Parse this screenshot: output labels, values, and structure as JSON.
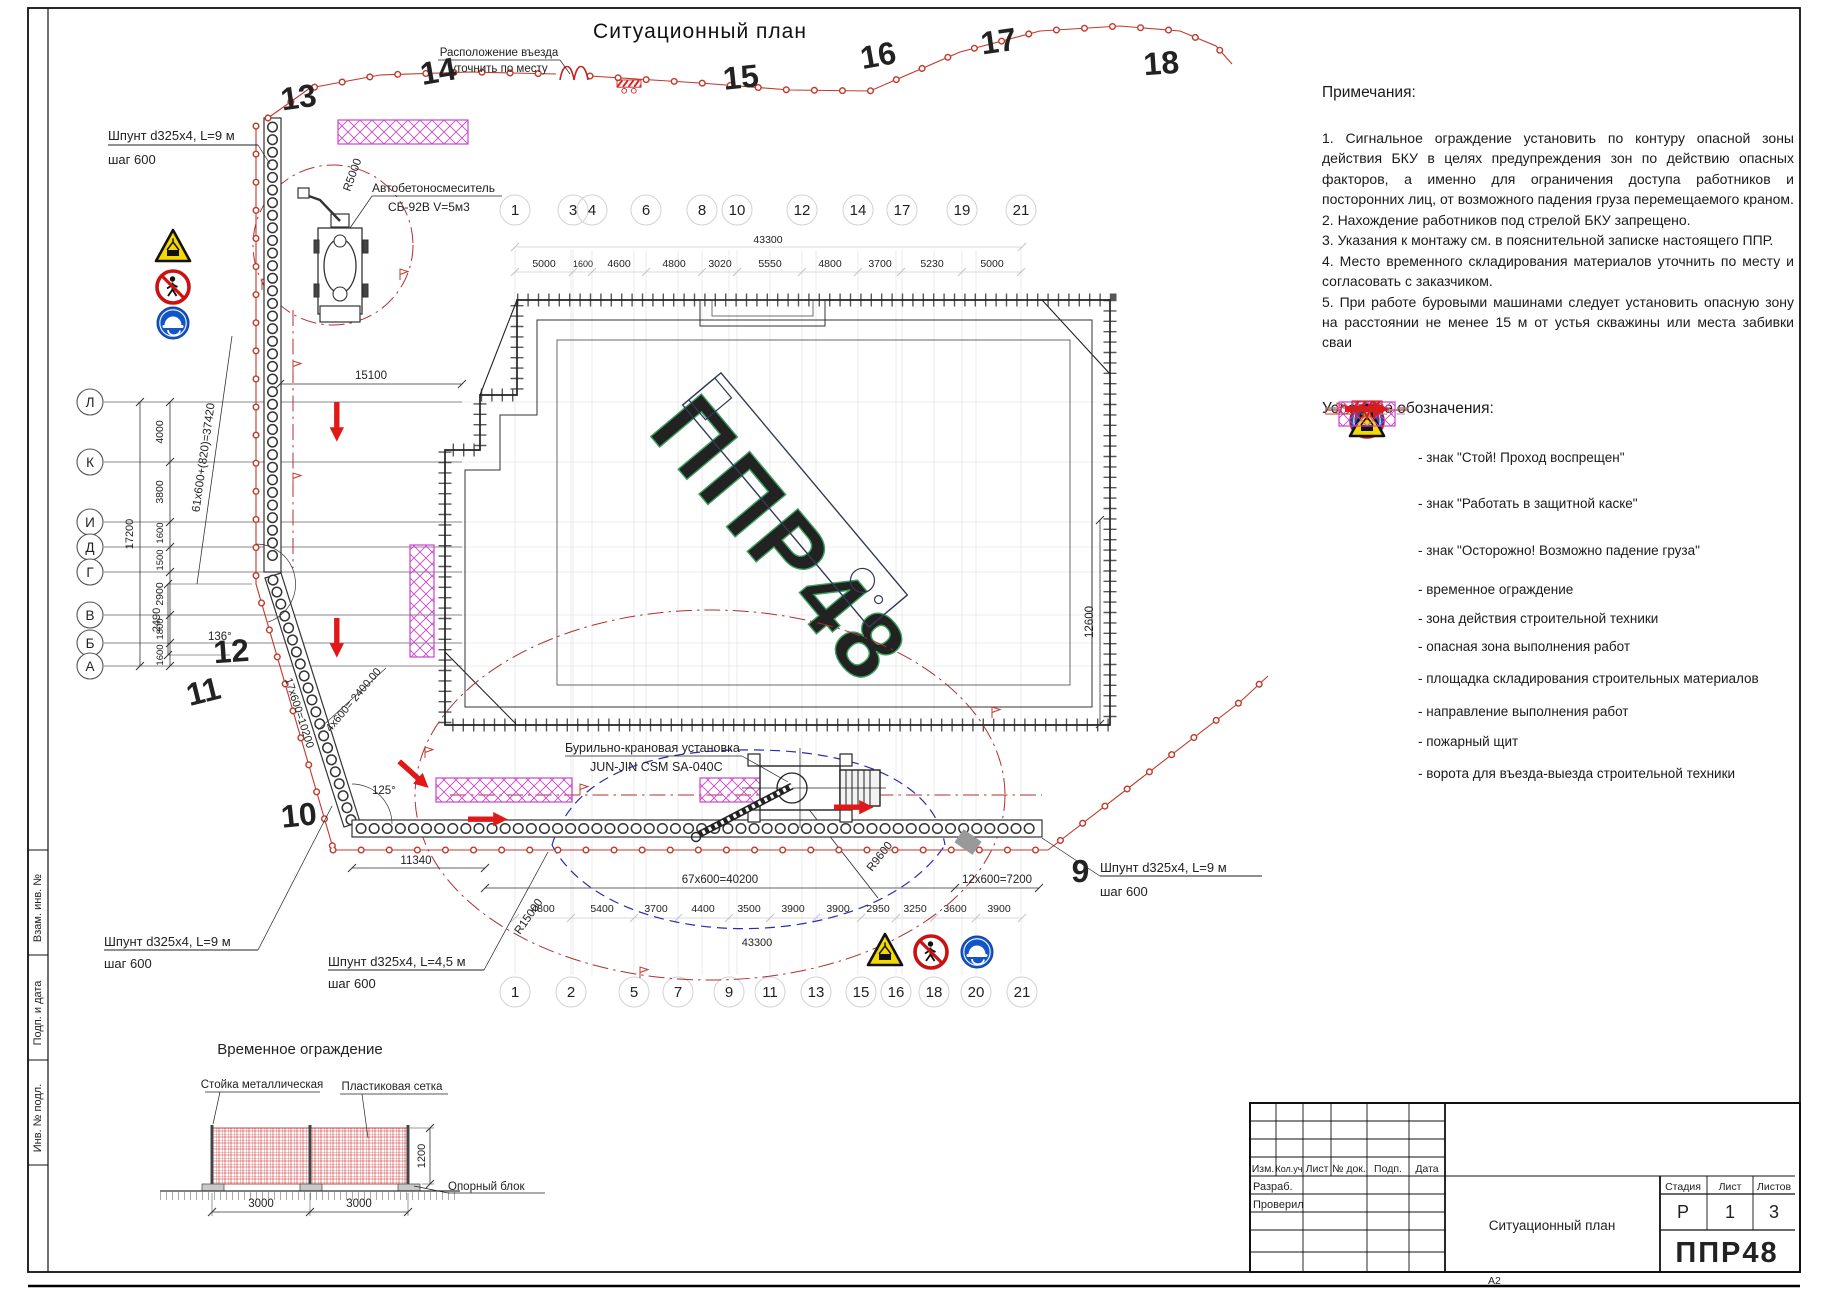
{
  "sheet": {
    "title": "Ситуационный план",
    "format": "А2",
    "frame_labels": [
      "Взам. инв. №",
      "Подп. и дата",
      "Инв. № подл."
    ]
  },
  "notes": {
    "heading": "Примечания:",
    "items": [
      "1. Сигнальное ограждение установить по контуру опасной зоны действия БКУ в целях предупреждения зон по действию опасных факторов, а именно для ограничения доступа работников и посторонних лиц, от возможного падения груза перемещаемого краном.",
      "2. Нахождение работников под стрелой БКУ запрещено.",
      "3. Указания к монтажу см. в пояснительной записке настоящего ППР.",
      "4. Место временного складирования материалов уточнить по месту и согласовать с заказчиком.",
      "5. При работе буровыми машинами следует установить опасную зону на расстоянии не менее 15 м от устья скважины или места забивки сваи"
    ]
  },
  "legend": {
    "heading": "Условные обозначения:",
    "items": [
      {
        "icon": "no-pedestrian-sign",
        "label": "- знак \"Стой! Проход воспрещен\""
      },
      {
        "icon": "hard-hat-sign",
        "label": "- знак \"Работать в защитной каске\""
      },
      {
        "icon": "falling-load-sign",
        "label": "- знак \"Осторожно! Возможно падение груза\""
      },
      {
        "icon": "temporary-fence-line",
        "label": "- временное ограждение"
      },
      {
        "icon": "machinery-zone-dash",
        "label": "- зона действия строительной техники"
      },
      {
        "icon": "danger-zone-line",
        "label": "- опасная зона выполнения работ"
      },
      {
        "icon": "storage-area-hatch",
        "label": "- площадка складирования строительных материалов"
      },
      {
        "icon": "work-direction-arrow",
        "label": "- направление выполнения работ"
      },
      {
        "icon": "fire-shield",
        "label": "- пожарный щит"
      },
      {
        "icon": "gate-symbol",
        "label": "- ворота для въезда-выезда строительной техники"
      }
    ]
  },
  "plan": {
    "entrance_note_1": "Расположение въезда",
    "entrance_note_2": "уточнить по месту",
    "truck_label_1": "Автобетоносмеситель",
    "truck_label_2": "СБ-92В V=5м3",
    "crane_label_1": "Бурильно-крановая установка",
    "crane_label_2": "JUN-JIN CSM SA-040C",
    "pile_left_1": "Шпунт d325x4, L=9 м",
    "pile_left_2": "шаг 600",
    "pile_bl_1": "Шпунт d325x4, L=9 м",
    "pile_bl_2": "шаг 600",
    "pile_bc_1": "Шпунт d325x4, L=4,5 м",
    "pile_bc_2": "шаг 600",
    "pile_r_1": "Шпунт d325x4, L=9 м",
    "pile_r_2": "шаг 600",
    "r_truck": "R5000",
    "r_crane": "R9600",
    "r_danger": "R15000",
    "angle_top": "136°",
    "angle_bottom": "125°",
    "fence_numbers": [
      "9",
      "10",
      "11",
      "12",
      "13",
      "14",
      "15",
      "16",
      "17",
      "18"
    ]
  },
  "grid": {
    "top_axes": [
      "1",
      "3",
      "4",
      "6",
      "8",
      "10",
      "12",
      "14",
      "17",
      "19",
      "21"
    ],
    "top_dims": [
      "5000",
      "1600",
      "4600",
      "4800",
      "3020",
      "5550",
      "4800",
      "3700",
      "5230",
      "5000"
    ],
    "top_total": "43300",
    "bottom_axes": [
      "1",
      "2",
      "5",
      "7",
      "9",
      "11",
      "13",
      "15",
      "16",
      "18",
      "20",
      "21"
    ],
    "bottom_dims": [
      "4800",
      "5400",
      "3700",
      "4400",
      "3500",
      "3900",
      "3900",
      "2950",
      "3250",
      "3600",
      "3900"
    ],
    "bottom_total": "43300",
    "left_axes": [
      "Л",
      "К",
      "И",
      "Д",
      "Г",
      "В",
      "Б",
      "А"
    ],
    "left_dims": [
      "4000",
      "3800",
      "1600",
      "1500",
      "2900",
      "1800",
      "1600"
    ],
    "left_total": "17200",
    "left_run": "61x600+(820)=37420",
    "dim_15100": "15100",
    "dim_11340": "11340",
    "dim_2490": "2490",
    "dim_12600": "12600",
    "run_bottom": "67x600=40200",
    "run_right": "12x600=7200",
    "run_diag_short": "4x600= 2400.00",
    "run_diag_long": "17x600=10200"
  },
  "detail": {
    "title": "Временное ограждение",
    "post_label": "Стойка металлическая",
    "mesh_label": "Пластиковая сетка",
    "block_label": "Опорный блок",
    "width_1": "3000",
    "width_2": "3000",
    "height": "1200"
  },
  "title_block": {
    "header_cols": [
      "Изм.",
      "Кол.уч",
      "Лист",
      "№ док.",
      "Подп.",
      "Дата"
    ],
    "row_labels": [
      "Разраб.",
      "Проверил"
    ],
    "stage_label": "Стадия",
    "sheet_label": "Лист",
    "sheets_label": "Листов",
    "stage": "Р",
    "sheet": "1",
    "sheets": "3",
    "doc_title": "Ситуационный план",
    "logo": "ППР48"
  },
  "colors": {
    "fence_red": "#c0392b",
    "arrow_red": "#e01818",
    "storage_magenta": "#cc44cc",
    "crane_zone_blue": "#2b2bb0",
    "sign_blue": "#1355c8",
    "warn_yellow": "#f5d800",
    "logo_green": "#2f9e4d"
  }
}
